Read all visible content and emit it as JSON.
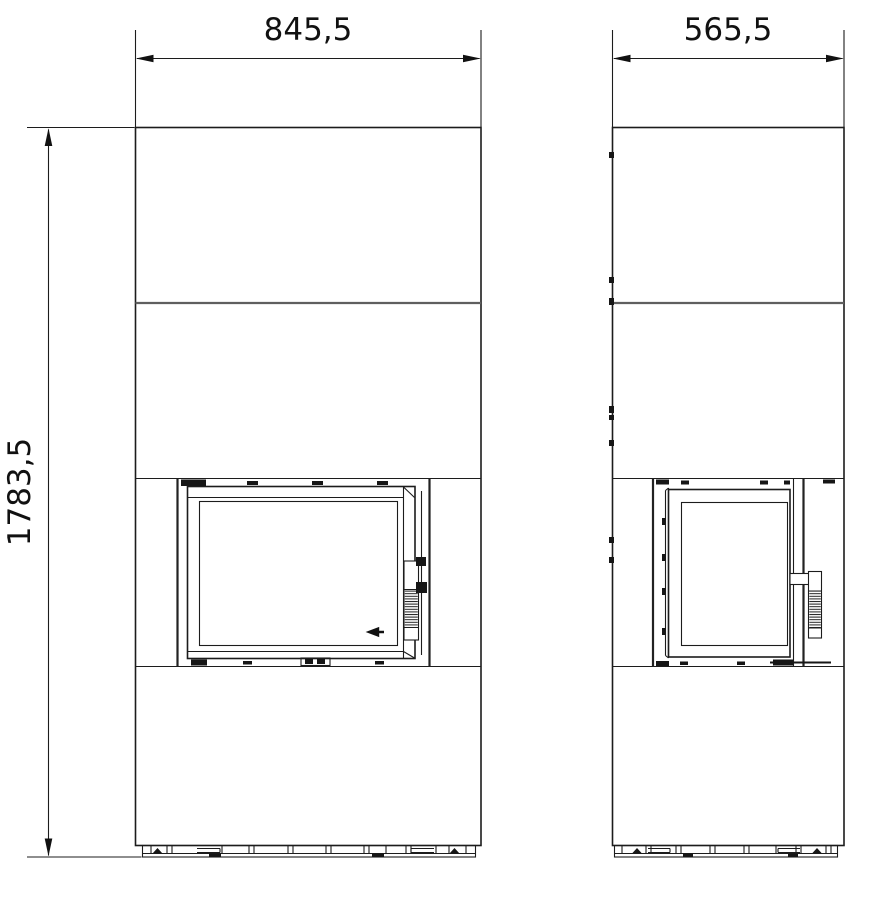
{
  "drawing": {
    "colors": {
      "background": "#ffffff",
      "line": "#1c1c1c",
      "panel_joint": "#5f5f5f",
      "dark_detail": "#161616"
    },
    "dimension_labels": {
      "front_width": "845,5",
      "side_width": "565,5",
      "overall_height": "1783,5"
    }
  }
}
